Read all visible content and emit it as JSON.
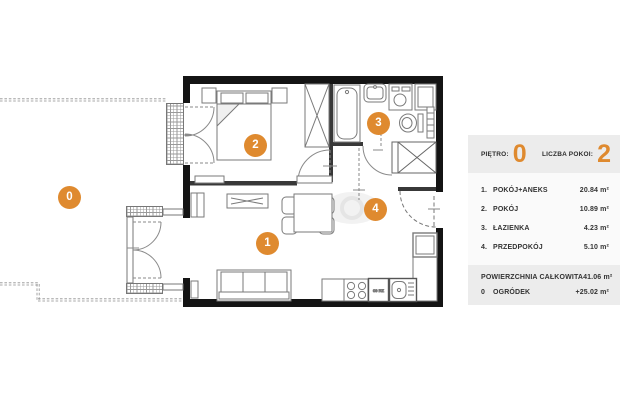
{
  "accent_color": "#DF8A2F",
  "plan": {
    "markers": [
      "0",
      "1",
      "2",
      "3",
      "4"
    ],
    "kitchen_appliance_label": "09 RZ"
  },
  "panel": {
    "floor_label": "PIĘTRO:",
    "floor_value": "0",
    "rooms_count_label": "LICZBA POKOI:",
    "rooms_count_value": "2",
    "rows": [
      {
        "num": "1.",
        "label": "POKÓJ+ANEKS",
        "area": "20.84 m²"
      },
      {
        "num": "2.",
        "label": "POKÓJ",
        "area": "10.89 m²"
      },
      {
        "num": "3.",
        "label": "ŁAZIENKA",
        "area": "4.23 m²"
      },
      {
        "num": "4.",
        "label": "PRZEDPOKÓJ",
        "area": "5.10 m²"
      }
    ],
    "total_row": {
      "label": "POWIERZCHNIA CAŁKOWITA",
      "area": "41.06 m²"
    },
    "garden_row": {
      "num": "0",
      "label": "OGRÓDEK",
      "area": "+25.02 m²"
    }
  }
}
